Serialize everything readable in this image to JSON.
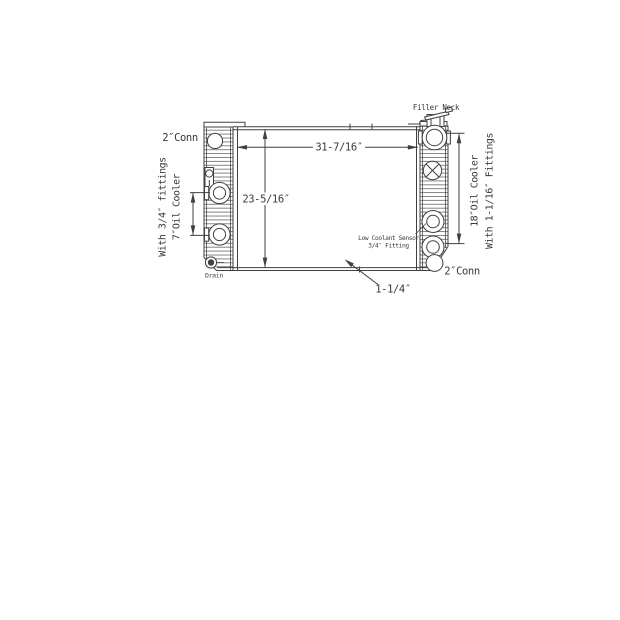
{
  "colors": {
    "background": "#ffffff",
    "line": "#404040",
    "text": "#3a3a3a"
  },
  "diagram": {
    "labels": {
      "conn_top_left": "2″Conn",
      "with_left_fittings": "With 3/4″ fittings",
      "left_oil_cooler": "7″Oil Cooler",
      "drain": "Drain",
      "width": "31-7/16″",
      "height": "23-5/16″",
      "filler_neck": "Filler Neck",
      "right_oil_cooler": "18″Oil Cooler",
      "with_right_fittings": "With 1-1/16″ Fittings",
      "low_coolant_sensor_1": "Low Coolant Sensor",
      "low_coolant_sensor_2": "3/4″ Fitting",
      "conn_bottom_right": "2″Conn",
      "core_thickness": "1-1/4″"
    }
  }
}
